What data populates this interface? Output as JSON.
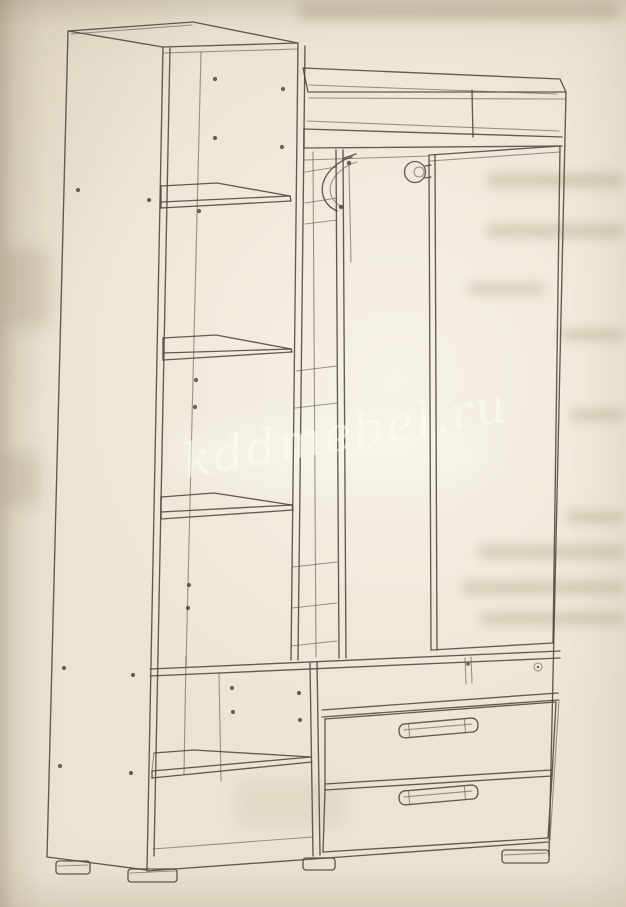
{
  "watermark": {
    "text": "kddmebel.ru",
    "color": "#FFFCF1"
  },
  "palette": {
    "paper": "#ebe4d3",
    "ink": "#4e463c"
  }
}
